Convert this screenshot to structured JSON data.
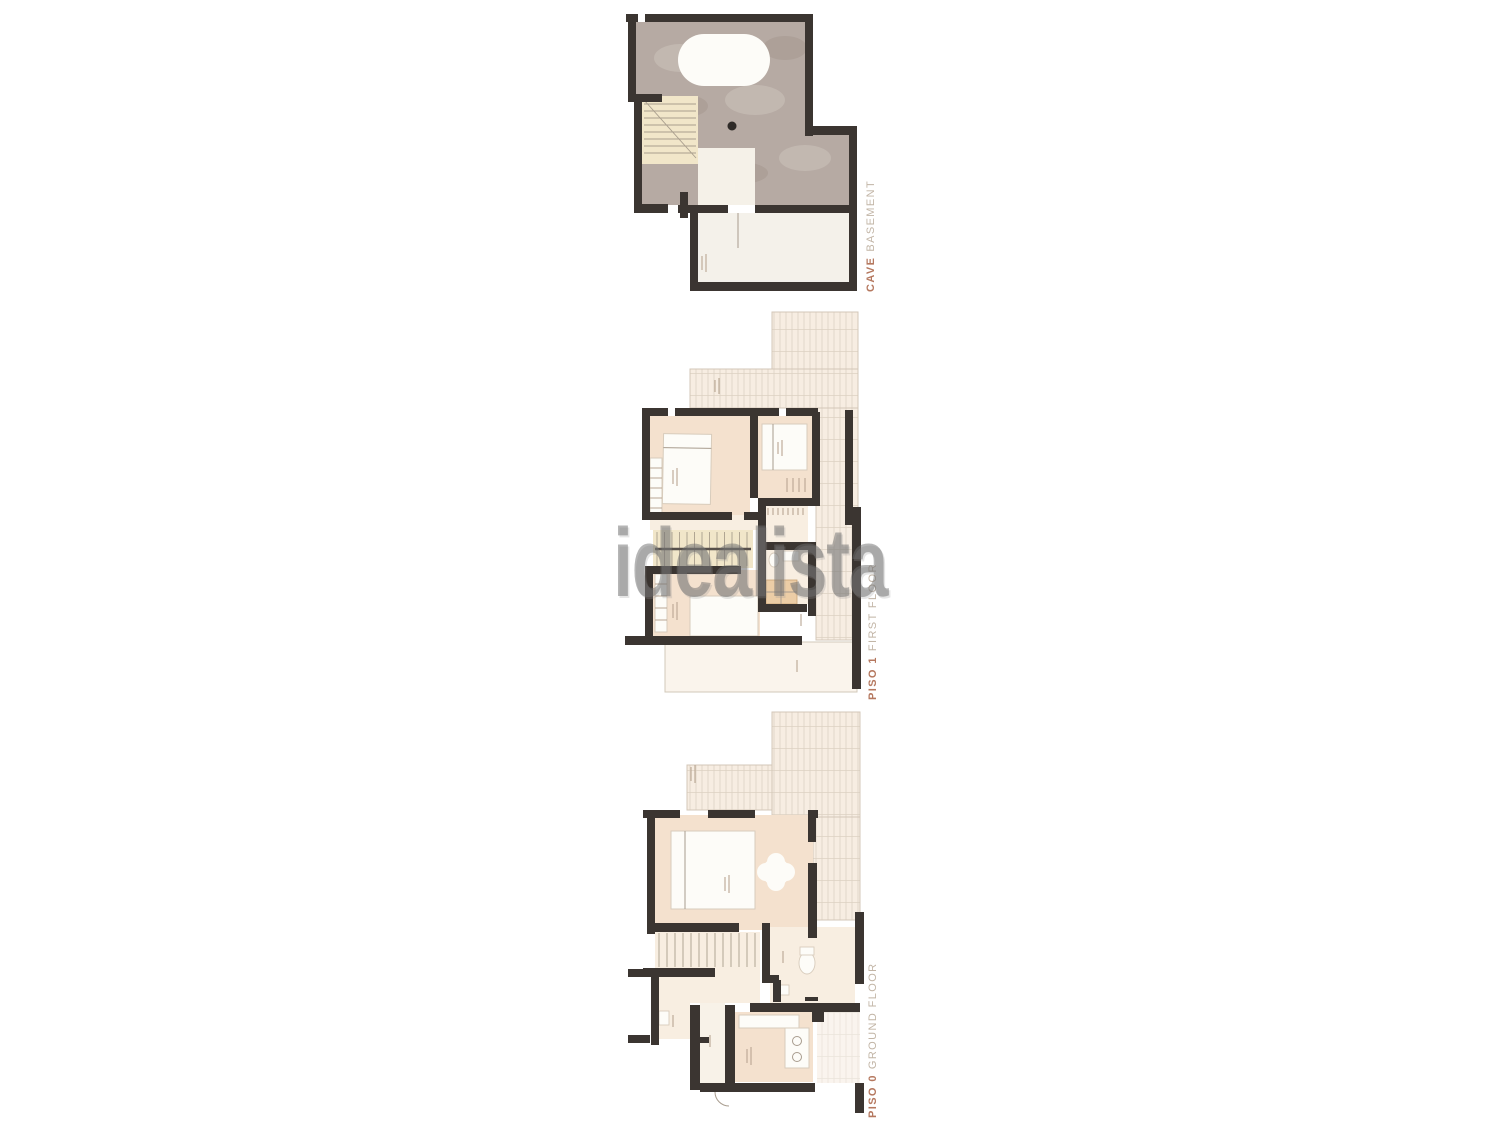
{
  "watermark": {
    "text": "idealista"
  },
  "floors": [
    {
      "id": "basement",
      "label_bold": "CAVE",
      "label_rest": "BASEMENT"
    },
    {
      "id": "first-floor",
      "label_bold": "PISO 1",
      "label_rest": "FIRST FLOOR"
    },
    {
      "id": "ground-floor",
      "label_bold": "PISO 0",
      "label_rest": "GROUND FLOOR"
    }
  ],
  "colors": {
    "wall": "#3b3531",
    "room_fill": "#f4e1ce",
    "room_fill_light": "#f8eee1",
    "terrace_bg": "#f7ede2",
    "terrace_line": "#ddd1c3",
    "terrace_outline": "#d3c7b8",
    "garage_fill": "#b6aaa3",
    "garage_light": "#ccc2bb",
    "garage_dark": "#a3968e",
    "stairs_fill": "#f1e6c9",
    "stair_line": "#a99e8d",
    "furniture": "#fdfcf8",
    "furniture_outline": "#d8ccbc",
    "shower_fill": "#eccda6",
    "shower_line": "#c9a274",
    "label_bold": "#b5785f",
    "label_rest": "#c2b5a6",
    "watermark_gray": "rgba(110,110,110,0.5)",
    "tick": "#b9a693"
  }
}
